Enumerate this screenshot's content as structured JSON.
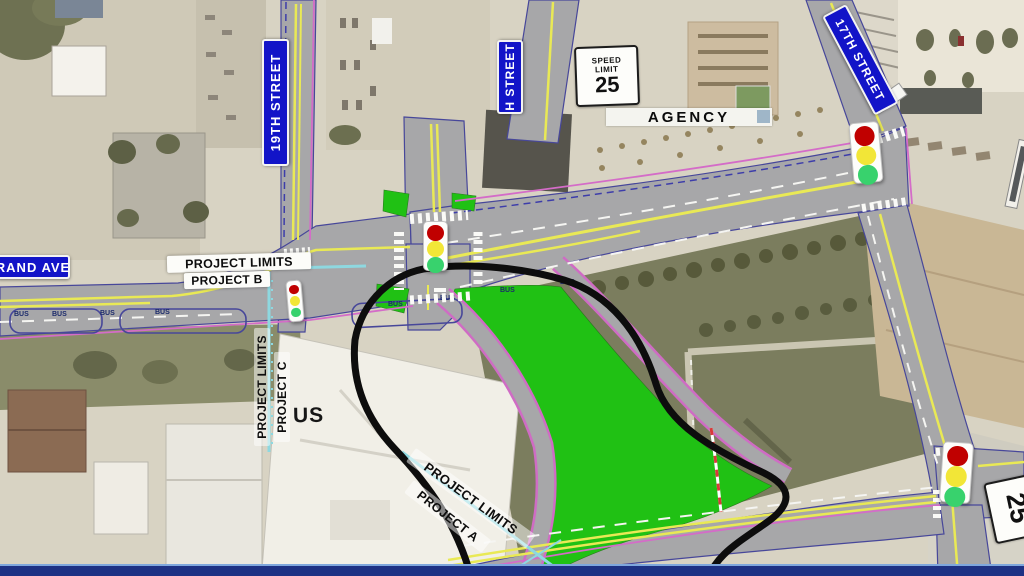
{
  "map": {
    "street_signs": {
      "s19th": "19TH STREET",
      "h": "H STREET",
      "s17th": "17TH STREET",
      "grand": "RAND AVE"
    },
    "speed_limit_sign": {
      "line1": "SPEED",
      "line2": "LIMIT",
      "value": "25"
    },
    "rotated_speed_sign_value": "25",
    "agency_label": "AGENCY",
    "building_label": "US",
    "project_labels": {
      "b_limits": "PROJECT LIMITS",
      "b_name": "PROJECT B",
      "c_limits": "PROJECT LIMITS",
      "c_name": "PROJECT C",
      "a_limits": "PROJECT LIMITS",
      "a_name": "PROJECT A"
    },
    "pavement_marking": "BUS",
    "traffic_signals": [
      {
        "name": "signal-grand-19th",
        "lights": "red yellow green"
      },
      {
        "name": "signal-central-intersection",
        "lights": "red yellow green"
      },
      {
        "name": "signal-17th-north",
        "lights": "red yellow green"
      },
      {
        "name": "signal-17th-south",
        "lights": "red yellow green"
      }
    ],
    "colors": {
      "street_sign_blue": "#1214c8",
      "project_area_outline": "#0d0d0d",
      "project_limit_line_cyan": "#8ed8e0",
      "proposed_green_space": "#20c114",
      "road_gray": "#a7a7a9",
      "lane_yellow": "#e9e955",
      "signal_red": "#c00000",
      "signal_yellow": "#f2e637",
      "signal_green": "#38d26d",
      "banner_blue": "#1d3184"
    }
  }
}
